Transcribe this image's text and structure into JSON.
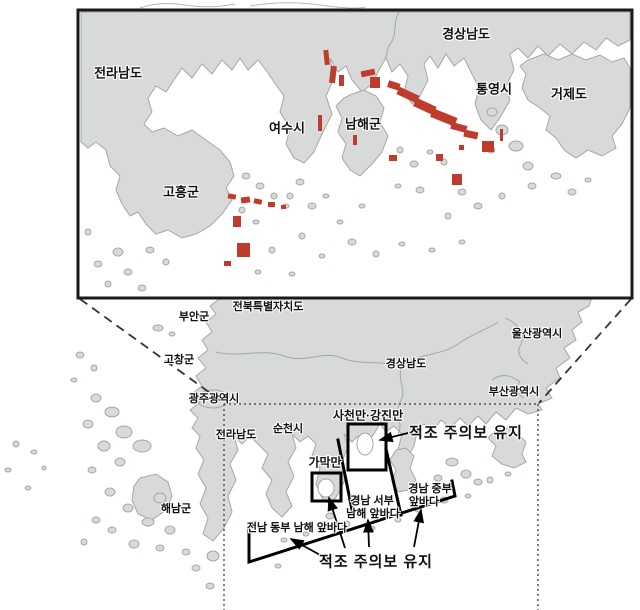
{
  "inset_labels": {
    "jeollanamdo": "전라남도",
    "gyeongsangnamdo": "경상남도",
    "tongyeong": "통영시",
    "geoje": "거제도",
    "yeosu": "여수시",
    "namhae": "남해군",
    "goheung": "고흥군"
  },
  "main_labels": {
    "jeonbuk": "전북특별자치도",
    "buan": "부안군",
    "gochang": "고창군",
    "gwangju": "광주광역시",
    "ulsan": "울산광역시",
    "gyeongnam": "경상남도",
    "busan": "부산광역시",
    "jeonnam": "전라남도",
    "suncheon": "순천시",
    "haenam": "해남군"
  },
  "zone_labels": {
    "sacheon_gangjin": "사천만·강진만",
    "gamak": "가막만",
    "gyeongnam_seobu_line1": "경남 서부",
    "gyeongnam_seobu_line2": "남해 앞바다",
    "gyeongnam_jungbu_line1": "경남 중부",
    "gyeongnam_jungbu_line2": "앞바다",
    "jeonnam_dongbu": "전남 동부 남해 앞바다"
  },
  "warnings": {
    "top": "적조 주의보 유지",
    "bottom": "적조 주의보 유지"
  },
  "colors": {
    "land": "#d7dad9",
    "land_outline": "#a3a8a8",
    "red_tide": "#bf3b2b",
    "sea": "#ffffff"
  }
}
